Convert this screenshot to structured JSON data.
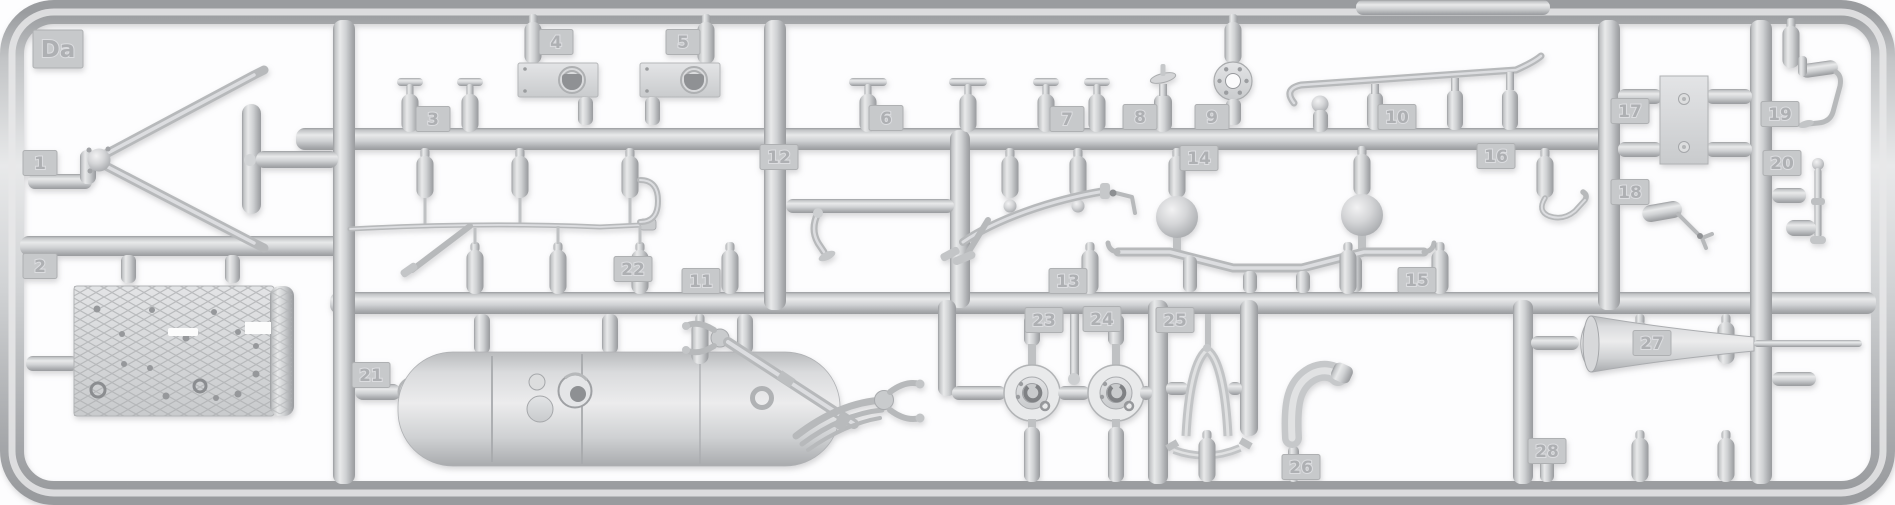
{
  "sprue": {
    "code": "Da",
    "part_tags": [
      "1",
      "2",
      "3",
      "4",
      "5",
      "6",
      "7",
      "8",
      "9",
      "10",
      "11",
      "12",
      "13",
      "14",
      "15",
      "16",
      "17",
      "18",
      "19",
      "20",
      "21",
      "22",
      "23",
      "24",
      "25",
      "26",
      "27",
      "28"
    ],
    "colors": {
      "plastic_base": "#cdcfd1",
      "plastic_highlight": "#e8e9ea",
      "plastic_shadow": "#9a9c9f",
      "tag_face": "#c7c9cb",
      "background": "#fdfdfe"
    },
    "parts": [
      {
        "number": "1",
        "shape": "triangular-drawbar-frame"
      },
      {
        "number": "2",
        "shape": "diamond-tread-floor-plate"
      },
      {
        "number": "3",
        "shape": "t-handle-pair"
      },
      {
        "number": "4",
        "shape": "bracket-plate-with-d-ring"
      },
      {
        "number": "5",
        "shape": "bracket-plate-with-d-ring"
      },
      {
        "number": "6",
        "shape": "t-handle-pair"
      },
      {
        "number": "7",
        "shape": "t-handle-pair"
      },
      {
        "number": "8",
        "shape": "valve-stem"
      },
      {
        "number": "9",
        "shape": "bolted-flange-ring"
      },
      {
        "number": "10",
        "shape": "long-curved-grab-rail"
      },
      {
        "number": "11",
        "shape": "long-tie-rod"
      },
      {
        "number": "12",
        "shape": "elbow-pipe"
      },
      {
        "number": "13",
        "shape": "curved-pipe"
      },
      {
        "number": "14",
        "shape": "twin-ball-stabilizer-bar"
      },
      {
        "number": "15",
        "shape": "small-fitting"
      },
      {
        "number": "16",
        "shape": "curved-hook"
      },
      {
        "number": "17",
        "shape": "mounting-plate-with-pegs"
      },
      {
        "number": "18",
        "shape": "small-linkage"
      },
      {
        "number": "19",
        "shape": "bent-control-rod"
      },
      {
        "number": "20",
        "shape": "ball-ended-rod"
      },
      {
        "number": "21",
        "shape": "cylindrical-fuel-tank"
      },
      {
        "number": "22",
        "shape": "axle-with-leaf-spring-and-forks"
      },
      {
        "number": "23",
        "shape": "brake-drum-hub"
      },
      {
        "number": "24",
        "shape": "brake-drum-hub"
      },
      {
        "number": "25",
        "shape": "a-frame-bracket"
      },
      {
        "number": "26",
        "shape": "curved-exhaust-elbow"
      },
      {
        "number": "27",
        "shape": "tapered-exhaust-horn"
      },
      {
        "number": "28",
        "shape": "small-fitting"
      }
    ]
  }
}
